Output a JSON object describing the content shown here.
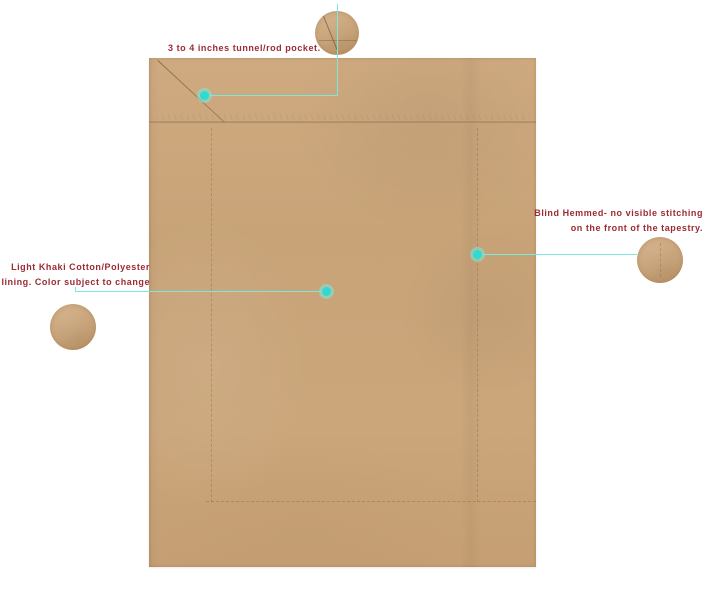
{
  "colors": {
    "background": "#ffffff",
    "fabric": "#c8a378",
    "fabric-light": "#cfaa80",
    "fabric-dark": "#bd9668",
    "seam": "#a5815a",
    "teal-line": "#7ce7df",
    "teal-dot": "#2edbd2",
    "note-text": "#9c2a33"
  },
  "notes": {
    "rod_pocket": {
      "text": "3 to 4 inches tunnel/rod pocket."
    },
    "blind_hem": {
      "line1": "Blind Hemmed- no visible stitching",
      "line2": "on the front of the tapestry."
    },
    "lining": {
      "line1": "Light Khaki Cotton/Polyester",
      "line2": "lining. Color subject to change"
    }
  }
}
